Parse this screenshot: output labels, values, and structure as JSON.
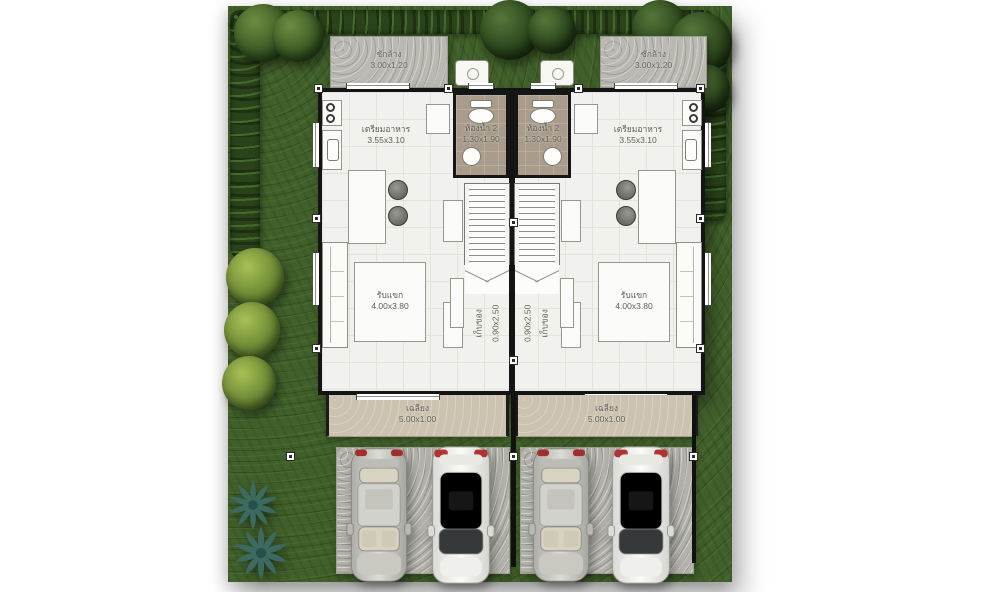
{
  "scene": {
    "type": "floor-plan-site-plan",
    "description": "Top view first-floor plan of a twin (duplex) house with garden, hedges, trees, two porches and four parked cars"
  },
  "units": [
    {
      "id": "left-unit",
      "rooms": {
        "laundry": {
          "label": "ซักล้าง",
          "size": "3.00x1.20"
        },
        "kitchen": {
          "label": "เตรียมอาหาร",
          "size": "3.55x3.10"
        },
        "bathroom": {
          "label": "ห้องน้ำ 2",
          "size": "1.30x1.90"
        },
        "storage": {
          "label": "เก็บของ",
          "size": "0.90x2.50"
        },
        "living": {
          "label": "รับแขก",
          "size": "4.00x3.80"
        },
        "porch": {
          "label": "เฉลียง",
          "size": "5.00x1.00"
        }
      },
      "cars": [
        "silver-sedan",
        "white-suv"
      ]
    },
    {
      "id": "right-unit",
      "rooms": {
        "laundry": {
          "label": "ซักล้าง",
          "size": "3.00x1.20"
        },
        "kitchen": {
          "label": "เตรียมอาหาร",
          "size": "3.55x3.10"
        },
        "bathroom": {
          "label": "ห้องน้ำ 2",
          "size": "1.30x1.90"
        },
        "storage": {
          "label": "เก็บของ",
          "size": "0.90x2.50"
        },
        "living": {
          "label": "รับแขก",
          "size": "4.00x3.80"
        },
        "porch": {
          "label": "เฉลียง",
          "size": "5.00x1.00"
        }
      },
      "cars": [
        "silver-sedan",
        "white-suv"
      ]
    }
  ],
  "colors": {
    "grass": "#41612a",
    "hedge": "#2a431b",
    "shrub": "#6d8a35",
    "palm": "#3c6a60",
    "concrete_pad": "#b9b9b1",
    "driveway": "#b2b2aa",
    "floor": "#f1f1ed",
    "bathroom_floor": "#a99c8b",
    "porch": "#ccc2b0",
    "wall": "#141414",
    "car_silver": "#c9c9c4",
    "car_white": "#efefec",
    "label_text": "#5d5c53"
  }
}
